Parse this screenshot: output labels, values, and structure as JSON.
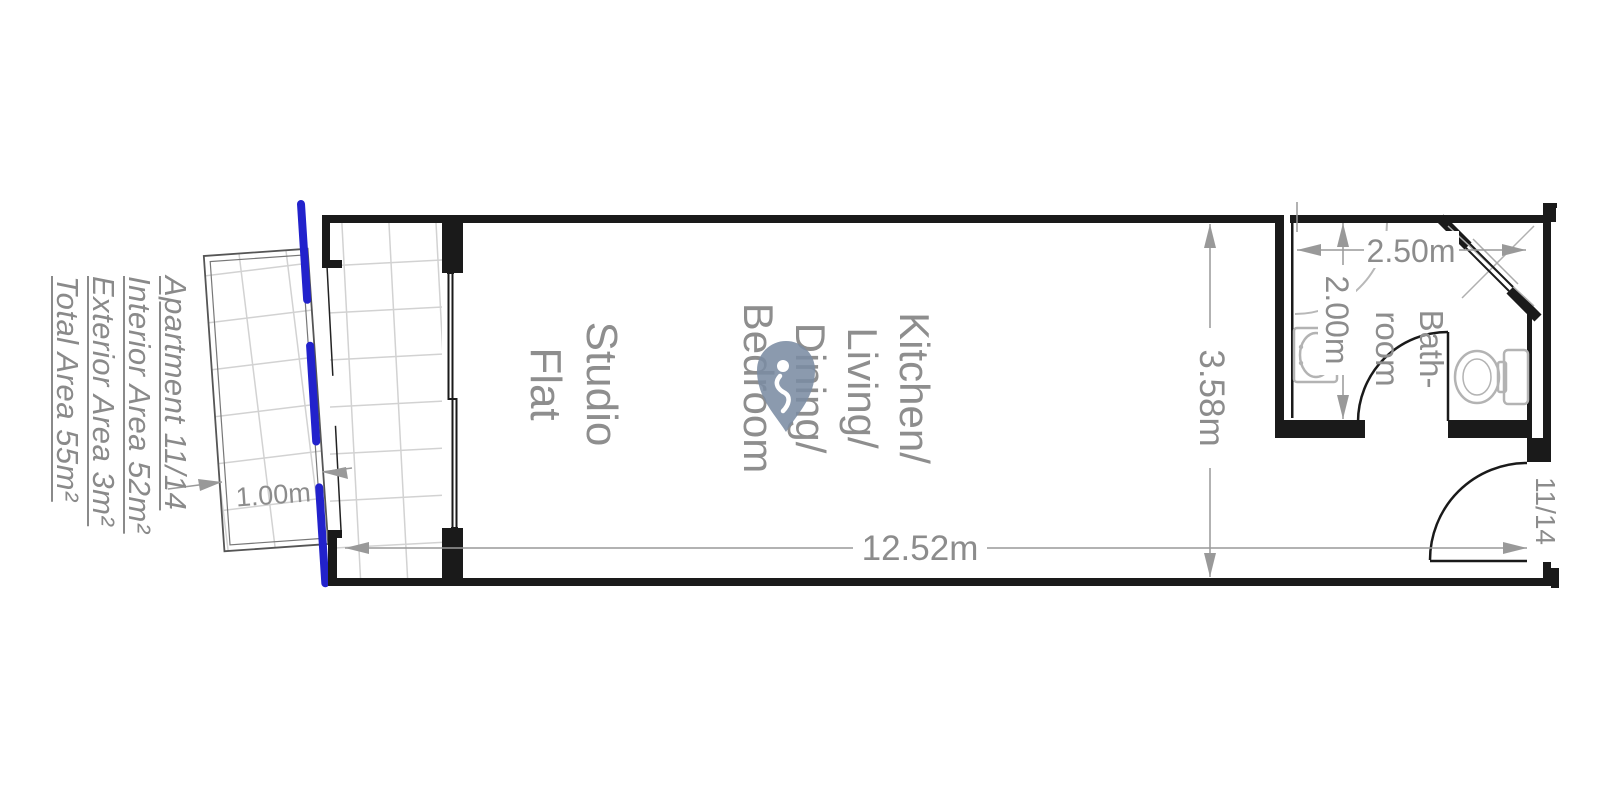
{
  "info_panel": {
    "lines": [
      "Apartment 11/14",
      "Interior Area 52m²",
      "Exterior Area 3m²",
      "Total Area 55m²"
    ]
  },
  "room_labels": {
    "studio_line1": "Studio",
    "studio_line2": "Flat",
    "main_line1": "Kitchen/",
    "main_line2": "Living/",
    "main_line3": "Dining/",
    "main_line4": "Bedroom",
    "bathroom_line1": "Bath-",
    "bathroom_line2": "room"
  },
  "dimensions": {
    "overall_width": "12.52m",
    "overall_depth": "3.58m",
    "bathroom_width": "2.50m",
    "bathroom_depth": "2.00m",
    "terrace_depth": "1.00m"
  },
  "entrance_unit": "11/14",
  "colors": {
    "wall": "#1a1a1a",
    "dimension_gray": "#8c8c8c",
    "fixture_gray": "#b3b3b3",
    "tile_gray": "#d2d2d2",
    "terrace_edge_blue": "#2222cc",
    "watermark_slate": "#7b8ca3"
  }
}
